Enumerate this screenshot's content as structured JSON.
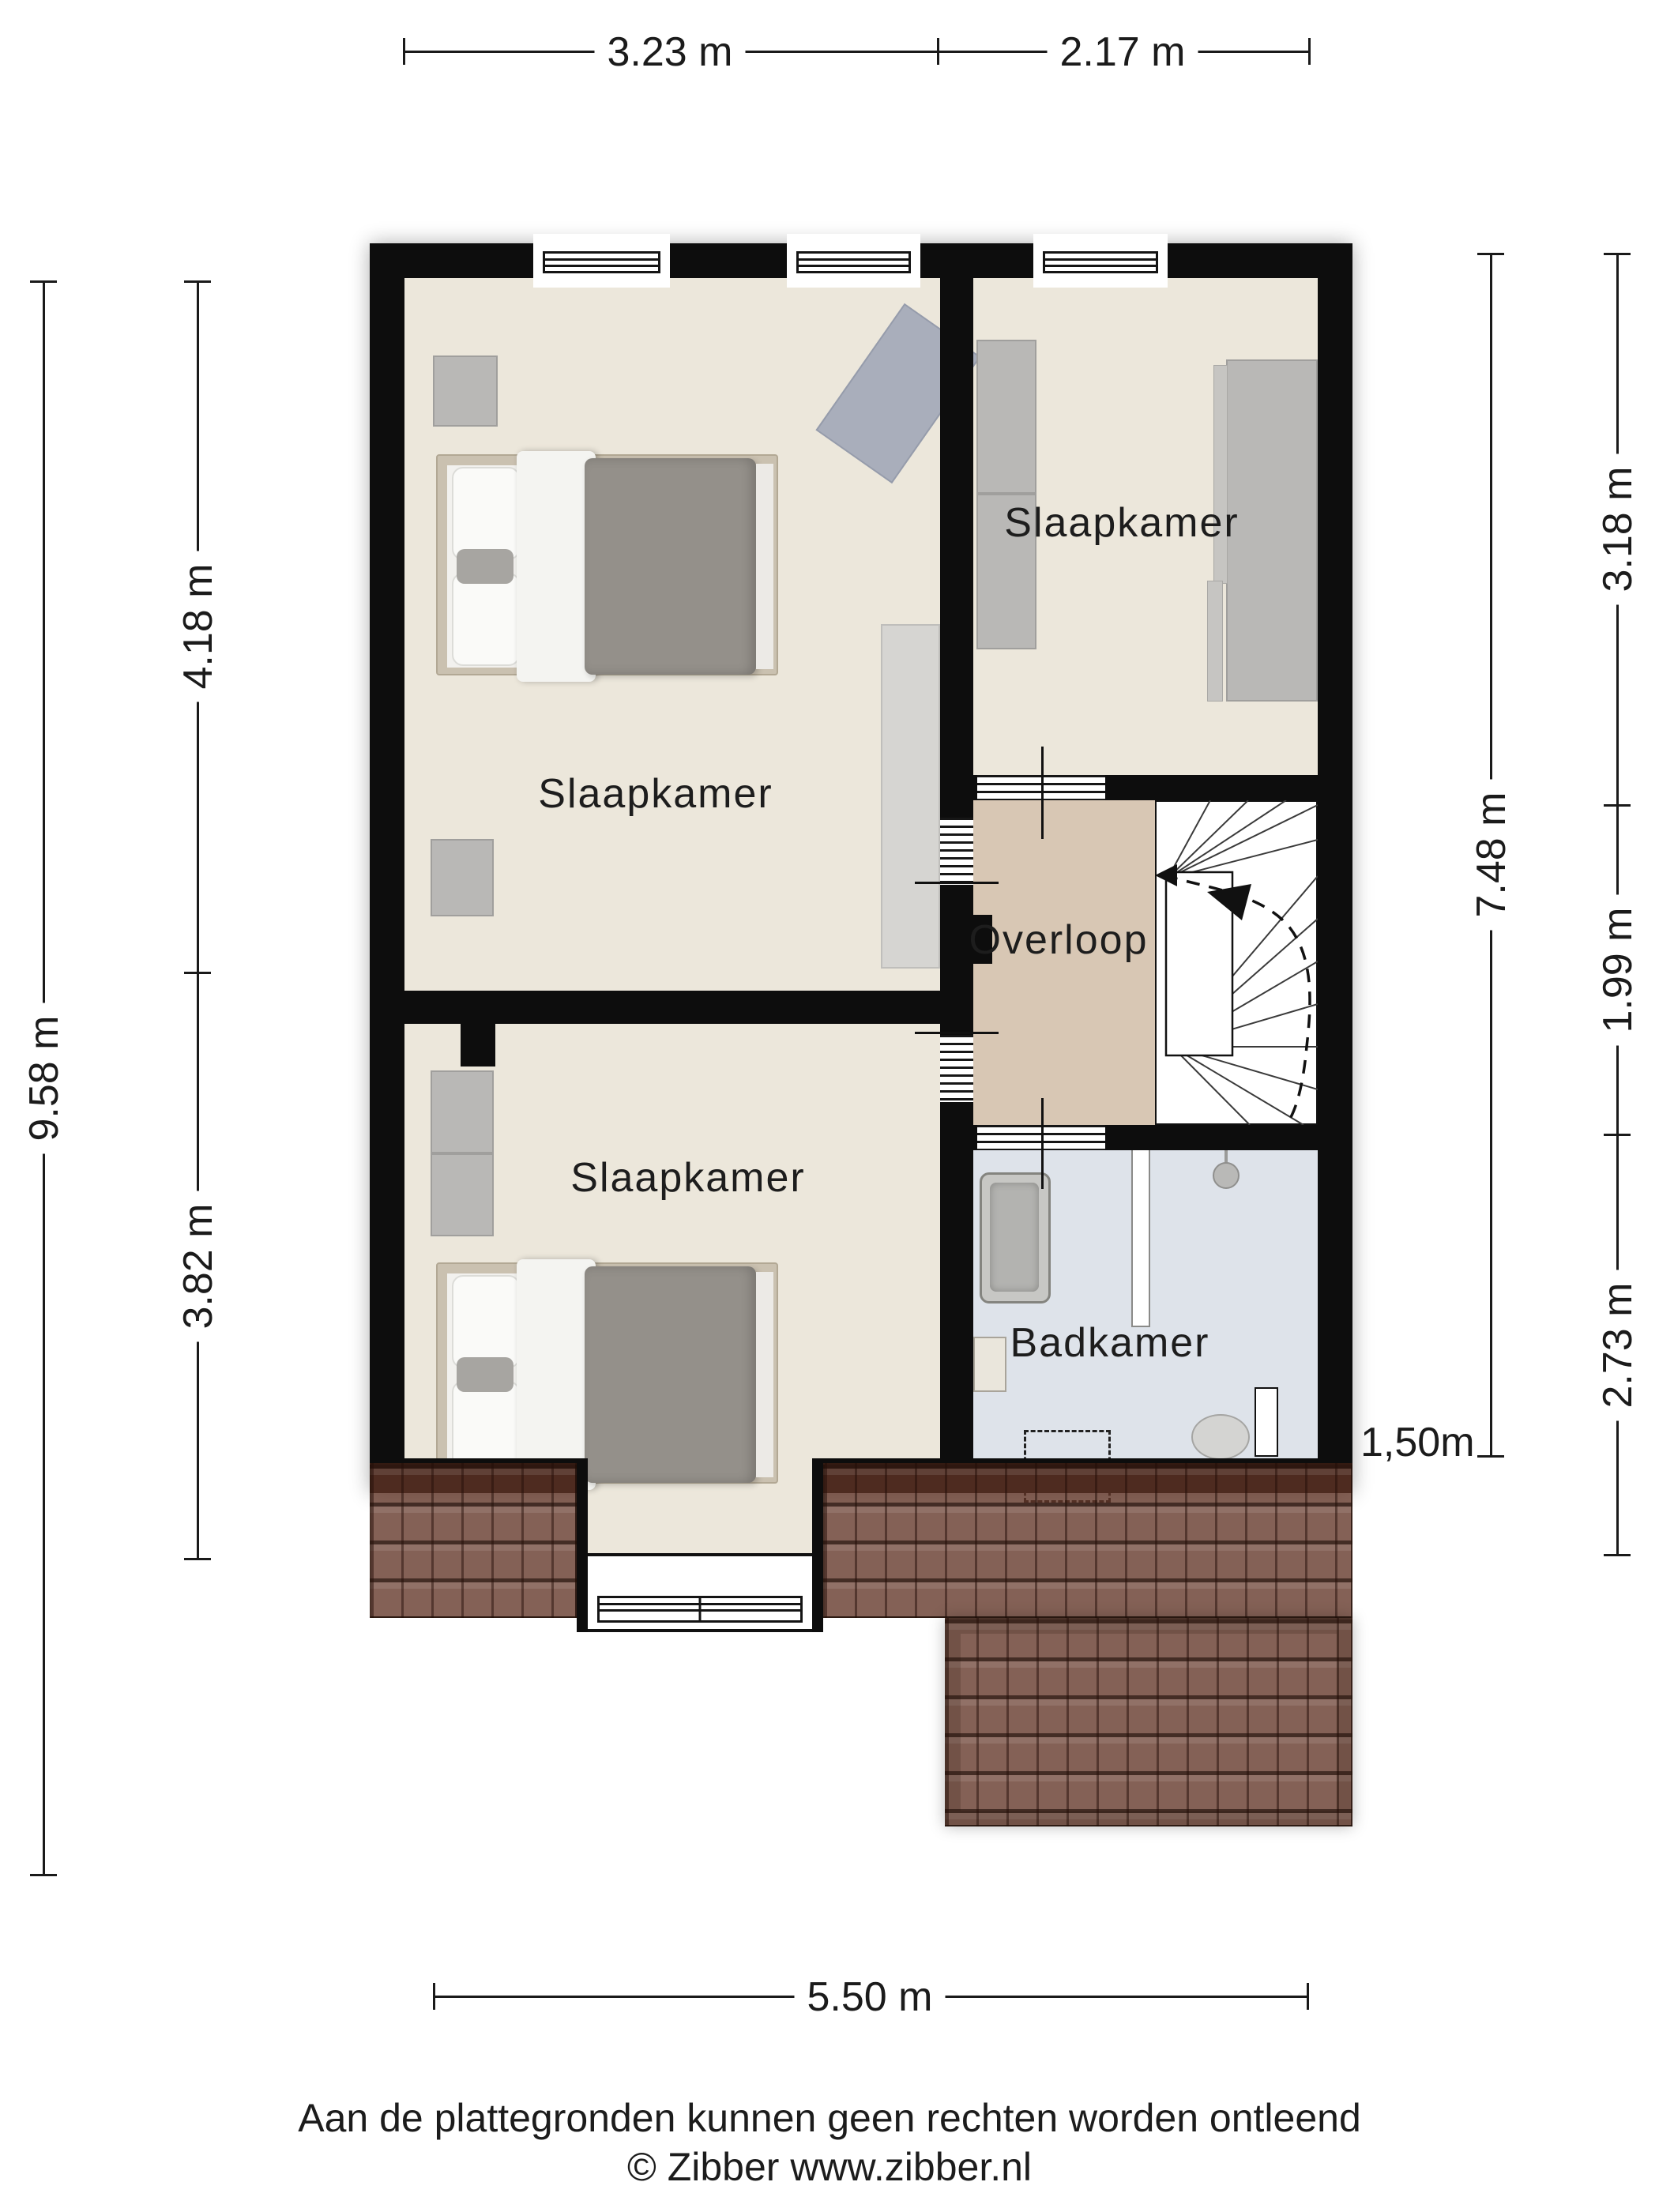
{
  "colors": {
    "wall": "#0d0d0d",
    "bedroom_floor": "#ece7db",
    "landing_floor": "#d8c7b4",
    "bathroom_floor": "#dee3ea",
    "roof_tile": "#61352a",
    "furniture_gray": "#b9b8b6",
    "duvet_gray": "#94908a",
    "bed_frame": "#cac1b0"
  },
  "rooms": {
    "bedroom_top_left": {
      "label": "Slaapkamer"
    },
    "bedroom_top_right": {
      "label": "Slaapkamer"
    },
    "bedroom_bottom_left": {
      "label": "Slaapkamer"
    },
    "landing": {
      "label": "Overloop"
    },
    "bathroom": {
      "label": "Badkamer"
    }
  },
  "dimensions": {
    "top": [
      {
        "label": "3.23 m"
      },
      {
        "label": "2.17 m"
      }
    ],
    "bottom": [
      {
        "label": "5.50 m"
      }
    ],
    "left_outer": [
      {
        "label": "9.58 m"
      }
    ],
    "left_inner": [
      {
        "label": "4.18 m"
      },
      {
        "label": "3.82 m"
      }
    ],
    "right_inner": [
      {
        "label": "7.48 m"
      }
    ],
    "right_outer": [
      {
        "label": "3.18 m"
      },
      {
        "label": "1.99 m"
      },
      {
        "label": "2.73 m"
      }
    ],
    "roof_clearance": {
      "label": "1,50m"
    }
  },
  "footer": {
    "disclaimer": "Aan de plattegronden kunnen geen rechten worden ontleend",
    "copyright": "© Zibber www.zibber.nl"
  }
}
